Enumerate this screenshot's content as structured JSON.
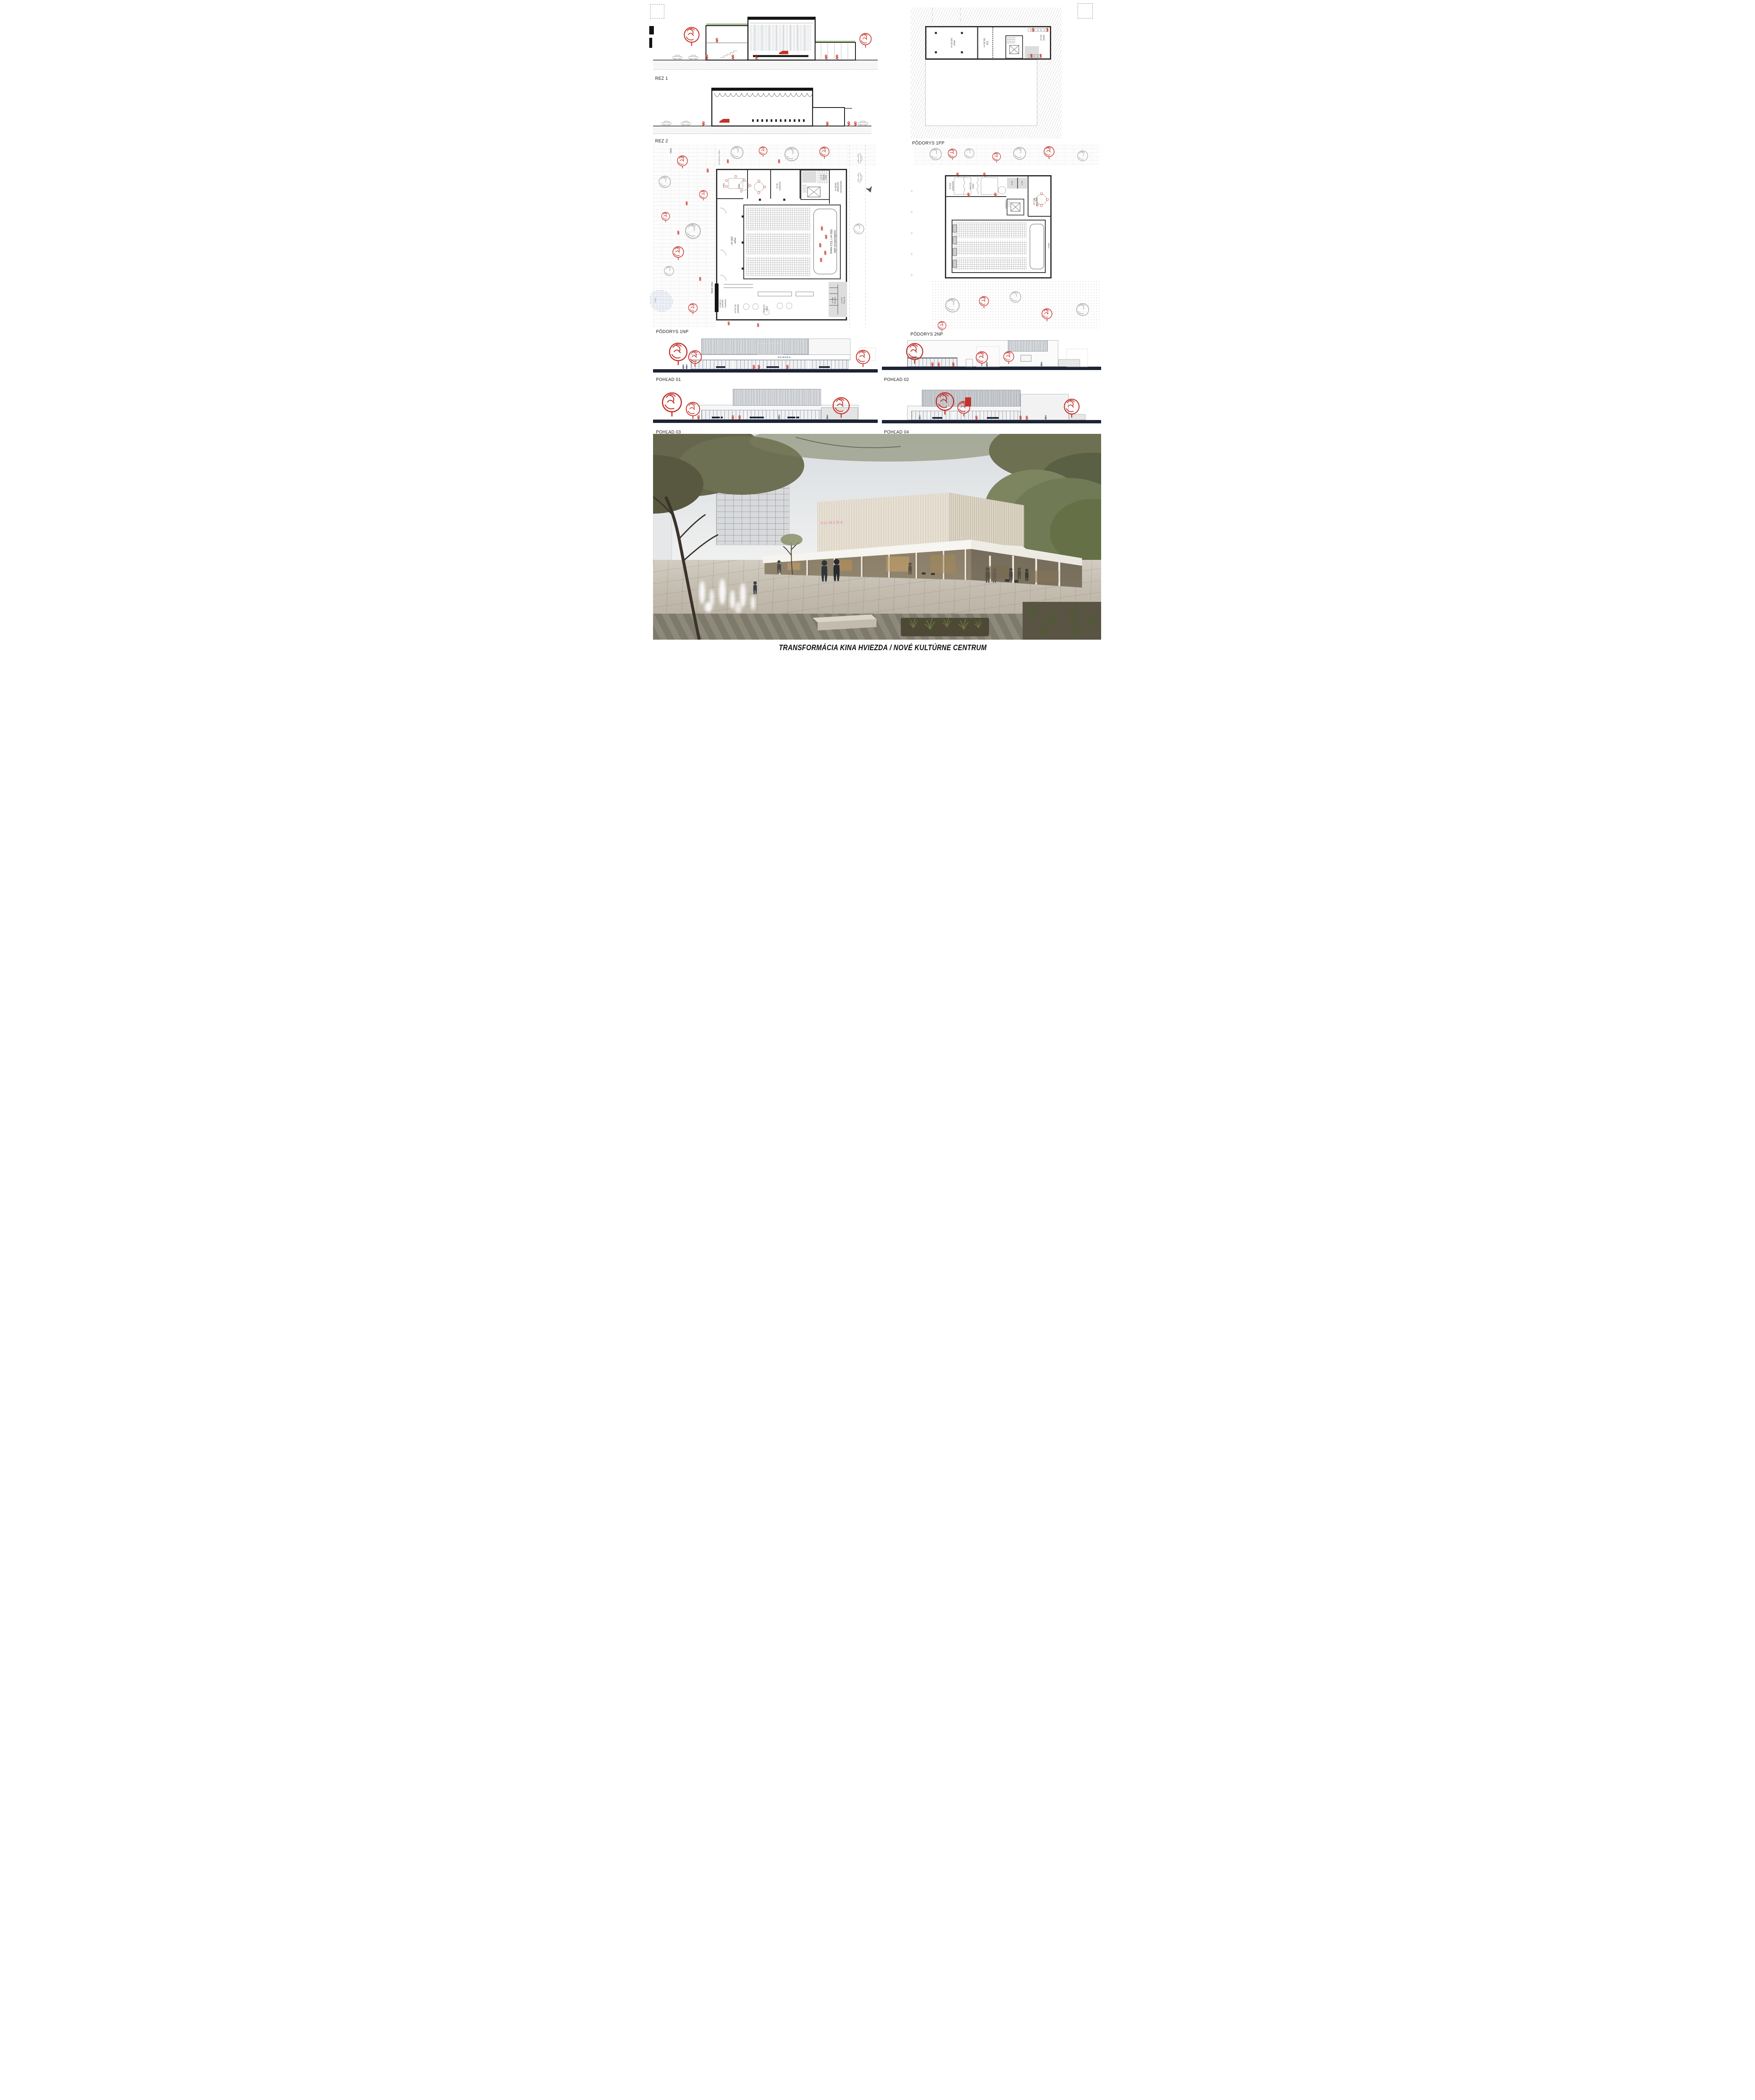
{
  "board": {
    "title": "TRANSFORMÁCIA KINA HVIEZDA / NOVÉ KULTÚRNE CENTRUM"
  },
  "colors": {
    "accent_red": "#c5322a",
    "ink": "#2f2f2f",
    "navy": "#1c2334",
    "neon_pink": "#dda4c6",
    "paper": "#ffffff"
  },
  "sections": {
    "rez1": {
      "label": "REZ 1"
    },
    "rez2": {
      "label": "REZ 2"
    }
  },
  "plans": {
    "p1pp": {
      "label": "PÔDORYS 1PP",
      "rooms": {
        "sklad": {
          "name": "sklad",
          "area": "146,50 m²"
        },
        "tzb": {
          "name": "TZB",
          "area": "88,36 m²"
        },
        "satne": {
          "name": "šatne",
          "area": "63 m²"
        }
      }
    },
    "p1np": {
      "label": "PÔDORYS 1NP",
      "site": {
        "street": "rasa",
        "alley": "stretávková ulička",
        "pond": "ryska"
      },
      "rooms": {
        "sala": {
          "name": "multifunkčná sála",
          "area": "650 m² / 513 miest"
        },
        "foyer": {
          "name": "foyer",
          "area": "300 m²"
        },
        "recepcia": {
          "name": "recepcia / kaviareň",
          "area": "37,98 m²"
        },
        "kaviaren": {
          "name": "kaviareň",
          "area": "70,74 m²"
        },
        "satna": {
          "name": "šatňa",
          "area": "33,58 m²"
        },
        "wc_muzi": {
          "name": "wc muži",
          "area": "20,9 m²"
        },
        "wc_zeny": {
          "name": "wc ženy",
          "area": "19,0 m²"
        },
        "backstage": {
          "name": "zásobovanie/ backstage",
          "area": "68,85 m²"
        },
        "sklad_stoliciek": {
          "name": "sklad stoličiek",
          "area": "8,4 m²"
        },
        "prenajom": {
          "name": "prenájom",
          "area": "55 m²"
        },
        "m68": {
          "name": "",
          "area": "68m²"
        },
        "m45": {
          "name": "",
          "area": "45m²"
        },
        "vstup": {
          "name": "hlavný vstup",
          "area": ""
        }
      }
    },
    "p2np": {
      "label": "PÔDORYS 2NP",
      "rooms": {
        "kancelarie": {
          "name": "kancelárie",
          "area": "120 m²"
        },
        "sklad": {
          "name": "sklad",
          "area": "17,4 m²"
        },
        "kuchynka": {
          "name": "kuchynka",
          "area": ""
        },
        "wc_m": {
          "name": "wc m.",
          "area": ""
        },
        "wc_z": {
          "name": "wc ž.",
          "area": ""
        },
        "prenajom": {
          "name": "prenájom",
          "area": "52,3 m²"
        },
        "balkon": {
          "name": "balkón",
          "area": ""
        }
      }
    }
  },
  "elevations": {
    "p01": {
      "label": "POHĽAD 01",
      "sign": "HVIEZDA"
    },
    "p02": {
      "label": "POHĽAD 02"
    },
    "p03": {
      "label": "POHĽAD 03"
    },
    "p04": {
      "label": "POHĽAD 04"
    }
  },
  "render": {
    "sign": "HVIEZDA"
  }
}
